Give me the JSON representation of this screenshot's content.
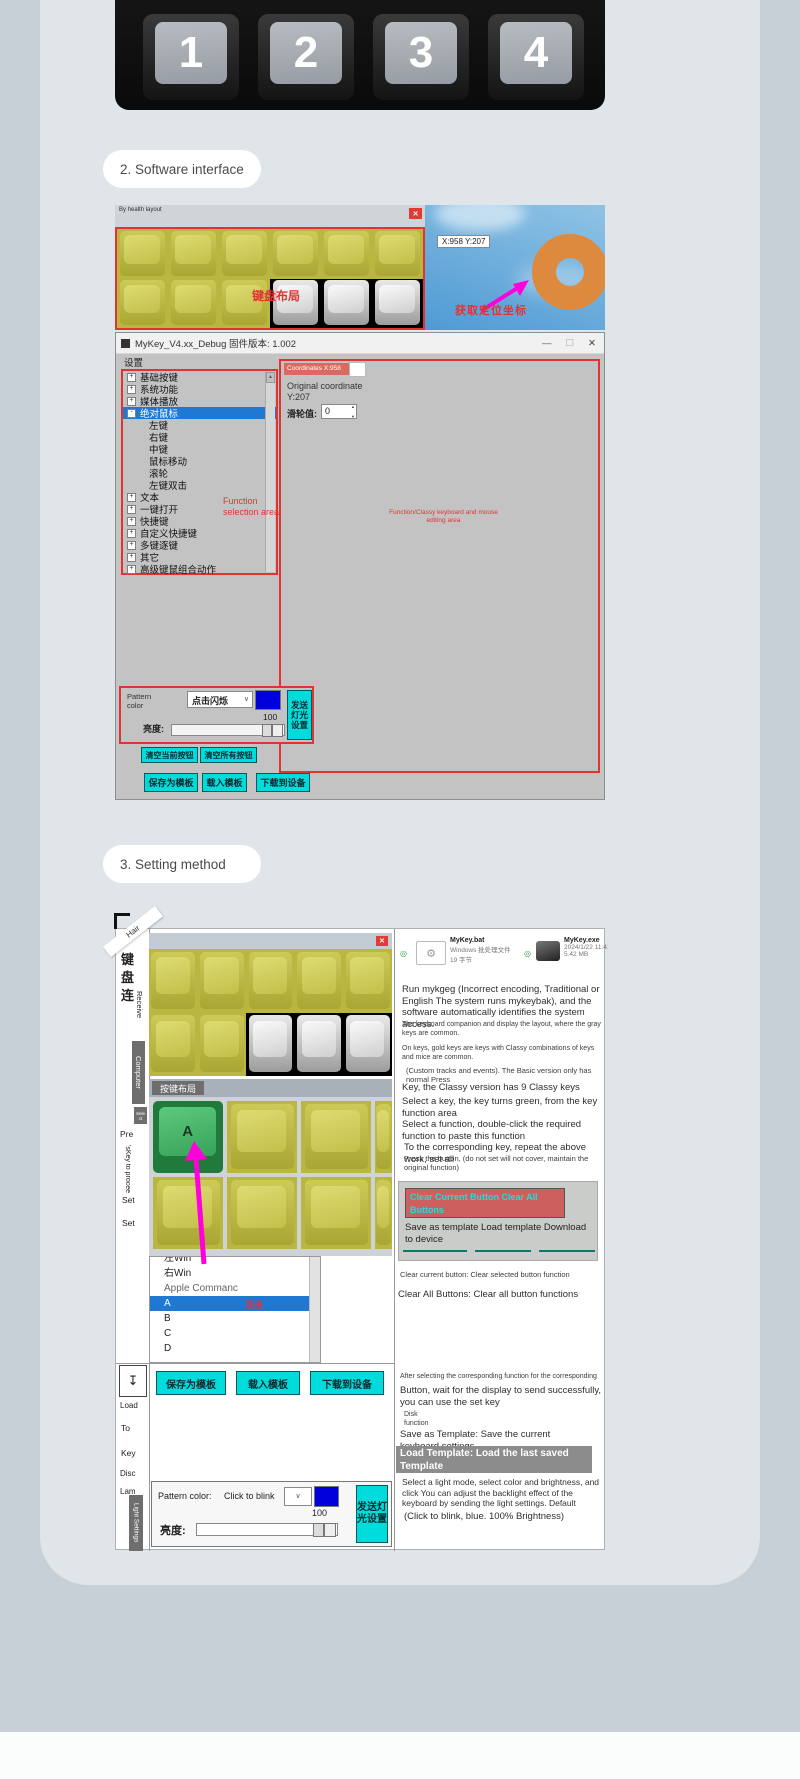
{
  "page": {
    "section2_title": "2. Software interface",
    "section3_title": "3. Setting method"
  },
  "colors": {
    "accent_cyan": "#00dcdc",
    "selection_blue": "#1f78d2",
    "annotation_red": "#e23333",
    "swatch_blue": "#0000dd",
    "key_yellow": "#cbc84e",
    "key_green": "#3fae63",
    "arrow_magenta": "#ff00dd",
    "salmon_box": "#d96a62",
    "teal_underline": "#0b7a6c",
    "highlight_gray": "#8c8c8c"
  },
  "icons": {
    "close": "✕",
    "minimize": "—",
    "maximize": "☐",
    "caret_down": "∨",
    "spinner_up": "▲",
    "spinner_down": "▼",
    "scroll_up": "▲",
    "download": "↧",
    "bullet": "◎",
    "gear": "⚙"
  },
  "keyboard_photo": {
    "keys": [
      "1",
      "2",
      "3",
      "4"
    ]
  },
  "preview": {
    "title": "By health layout",
    "layout_label": "键盘布局",
    "tooltip": "X:958 Y:207",
    "locate_label": "获取定位坐标"
  },
  "mykey": {
    "title": "MyKey_V4.xx_Debug 固件版本: 1.002",
    "menu": "设置",
    "tree": {
      "annotation": "Function selection area",
      "items": [
        {
          "label": "基础按键",
          "exp": "+"
        },
        {
          "label": "系统功能",
          "exp": "+"
        },
        {
          "label": "媒体播放",
          "exp": "+"
        },
        {
          "label": "绝对鼠标",
          "exp": "-"
        },
        {
          "label": "左键"
        },
        {
          "label": "右键"
        },
        {
          "label": "中键"
        },
        {
          "label": "鼠标移动"
        },
        {
          "label": "滚轮"
        },
        {
          "label": "左键双击"
        },
        {
          "label": "文本",
          "exp": "+"
        },
        {
          "label": "一键打开",
          "exp": "+"
        },
        {
          "label": "快捷键",
          "exp": "+"
        },
        {
          "label": "自定义快捷键",
          "exp": "+"
        },
        {
          "label": "多键逐键",
          "exp": "+"
        },
        {
          "label": "其它",
          "exp": "+"
        },
        {
          "label": "高级键鼠组合动作",
          "exp": "+"
        }
      ]
    },
    "coords": {
      "header": "Coordinates X:958",
      "original": "Original coordinate Y:207",
      "wheel_label": "滑轮值:",
      "wheel_value": "0",
      "annotation": "Function/Classy keyboard and mouse editing area"
    },
    "light": {
      "pattern_label": "Pattern color",
      "pattern_value": "点击闪烁",
      "send_button": "发送灯光设置",
      "brightness_label": "亮度:",
      "brightness_value": "100"
    },
    "buttons": {
      "clear_current": "清空当前按钮",
      "clear_all": "清空所有按钮",
      "save_template": "保存为模板",
      "load_template": "载入模板",
      "download": "下载到设备"
    }
  },
  "setting": {
    "sidebar": {
      "ribbon": "Hair",
      "char1": "键",
      "char2": "盘",
      "char3": "连",
      "receive": "Receive",
      "computer": "Computer",
      "select": "Sele ct",
      "pre": "Pre",
      "key_to": "'sKey to procee",
      "set1": "Set",
      "set2": "Set",
      "load": "Load",
      "to": "To",
      "key": "Key",
      "disc": "Disc",
      "lam": "Lam",
      "light": "Light Settings"
    },
    "left": {
      "keylayout_title": "按键布局",
      "selected_key": "A",
      "list": [
        "左Win",
        "右Win",
        "Apple Commanc",
        "A",
        "B",
        "C",
        "D"
      ],
      "list_annotation": "双击",
      "buttons": {
        "save": "保存为模板",
        "load": "载入模板",
        "download": "下载到设备"
      },
      "light": {
        "pattern_label": "Pattern color:",
        "pattern_value": "Click to blink",
        "send_button": "发送灯光设置",
        "brightness_label": "亮度:",
        "brightness_value": "100"
      }
    },
    "right": {
      "files": [
        {
          "name": "MyKey.bat",
          "meta1": "Windows 批处理文件",
          "meta2": "19 字节"
        },
        {
          "name": "MyKey.exe",
          "meta1": "2024/1/22 11:41",
          "meta2": "5.42 MB"
        }
      ],
      "p_run": "Run mykgeg (Incorrect encoding, Traditional or English The system runs mykeybak), and the software automatically identifies the system access.",
      "s_companion": "The keyboard companion and display the layout, where the gray keys are common.",
      "s_goldkeys": "On keys, gold keys are keys with Classy combinations of keys and mice are common.",
      "s_custom": "(Custom tracks and events). The Basic version only has normal Press",
      "p_classy": "Key, the Classy version has 9 Classy keys",
      "p_select_key": "Select a key, the key turns green, from the key function area",
      "p_select_fn": "Select a function, double-click the required function to paste this function",
      "p_corresponding": "To the corresponding key, repeat the above work, set all",
      "s_press": "Press the button, (do not set will not cover, maintain the original function)",
      "panel_clear": "Clear Current Button Clear All Buttons",
      "panel_save": "Save as template Load template Download to device",
      "s_clear_current": "Clear current button: Clear selected button function",
      "p_clear_all": "Clear All Buttons: Clear all button functions",
      "s_after": "After selecting the corresponding function for the corresponding",
      "p_wait": "Button, wait for the display to send successfully, you can use the set key",
      "s_disk": "Disk function",
      "p_save_template": "Save as Template: Save the current keyboard settings",
      "hl_load_template": "Load Template: Load the last saved Template",
      "p_light": "Select a light mode, select color and brightness, and click You can adjust the backlight effect of the keyboard by sending the light settings. Default",
      "p_default": "(Click to blink, blue. 100% Brightness)"
    }
  }
}
